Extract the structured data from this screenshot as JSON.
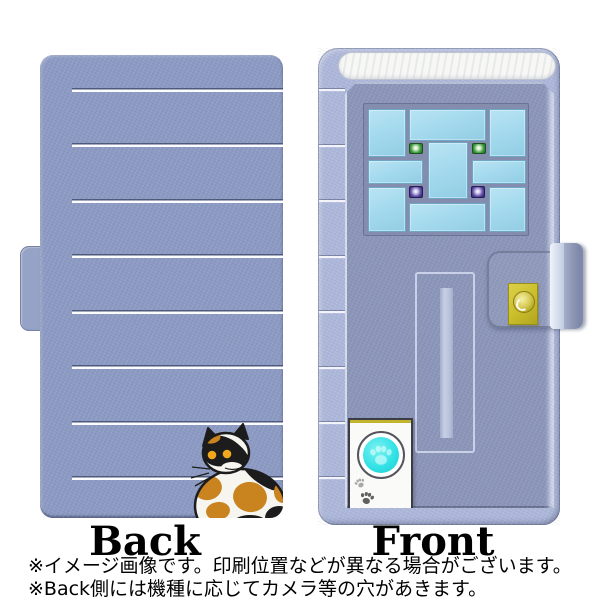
{
  "labels": {
    "back": "Back",
    "front": "Front"
  },
  "footer": {
    "note1": "※イメージ画像です。印刷位置などが異なる場合がございます。",
    "note2": "※Back側には機種に応じてカメラ等の穴があきます。"
  },
  "icons": {
    "paw_button": "paw-print",
    "paw_marks": "paw-print",
    "snap": "round-gold-snap-button"
  },
  "colors": {
    "page_bg": "#ffffff",
    "cover": "#8d9bc4",
    "cover_tab": "#96a2c6",
    "case_edge": "#aeb8da",
    "door_face": "#8c96b9",
    "stripe_light": "#fbfcfe",
    "transom": "#f7f7f4",
    "window_frame": "#848dae",
    "window_pane": "#a5daee",
    "pane_border": "#6ea6c6",
    "lamp_green": "#2e8a3a",
    "lamp_purple": "#4a3c92",
    "mail_outline": "#c9d1e8",
    "mail_bar": "#b7c0da",
    "doorbell_box": "#fafaf8",
    "doorbell_cyan": "#2ee0e4",
    "snap_gold": "#c9bd2a",
    "cat_white": "#f7f5f0",
    "cat_black": "#1c1c1c",
    "cat_orange": "#c9831f",
    "cat_eye": "#f2a81d",
    "text": "#000000"
  }
}
